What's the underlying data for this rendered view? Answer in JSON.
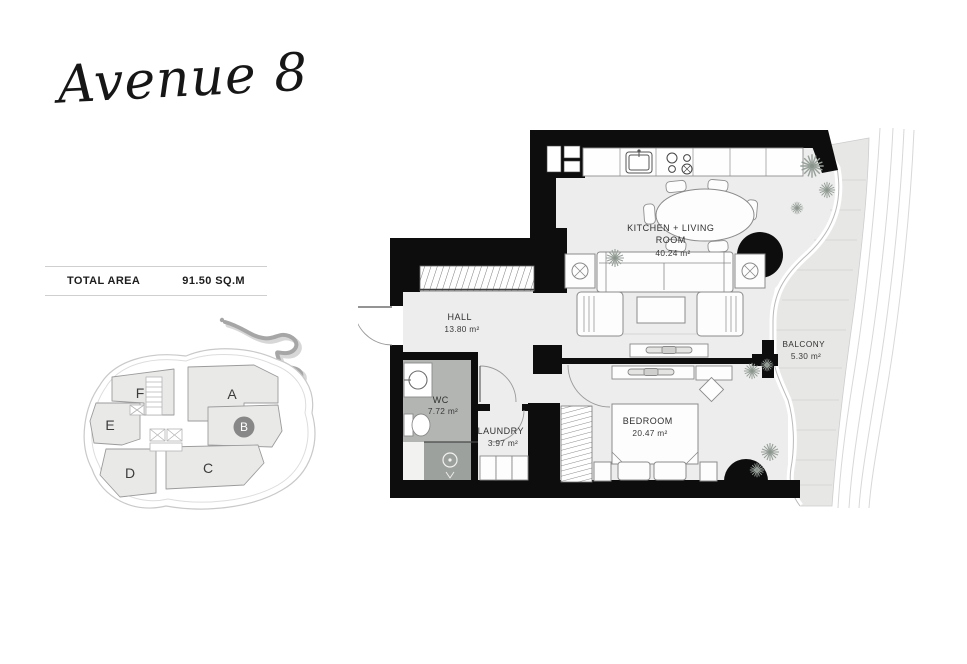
{
  "logo": {
    "text": "Avenue 8"
  },
  "total_area": {
    "label": "TOTAL AREA",
    "value": "91.50 SQ.M"
  },
  "key_plan": {
    "units": [
      {
        "label": "F",
        "highlighted": false
      },
      {
        "label": "A",
        "highlighted": false
      },
      {
        "label": "E",
        "highlighted": false
      },
      {
        "label": "B",
        "highlighted": true
      },
      {
        "label": "D",
        "highlighted": false
      },
      {
        "label": "C",
        "highlighted": false
      }
    ],
    "highlight_color": "#878787"
  },
  "floor_plan": {
    "rooms": {
      "kitchen_living": {
        "line1": "KITCHEN + LIVING",
        "line2": "ROOM",
        "area": "40.24 m²"
      },
      "hall": {
        "name": "HALL",
        "area": "13.80 m²"
      },
      "wc": {
        "name": "WC",
        "area": "7.72 m²"
      },
      "laundry": {
        "name": "LAUNDRY",
        "area": "3.97 m²"
      },
      "bedroom": {
        "name": "BEDROOM",
        "area": "20.47 m²"
      },
      "balcony": {
        "name": "BALCONY",
        "area": "5.30 m²"
      }
    },
    "colors": {
      "wall": "#0d0d0d",
      "floor": "#ecedec",
      "wet_floor": "#b2b5b2",
      "shower_floor": "#9da19e",
      "balcony_floor": "#e7e8e6"
    }
  }
}
